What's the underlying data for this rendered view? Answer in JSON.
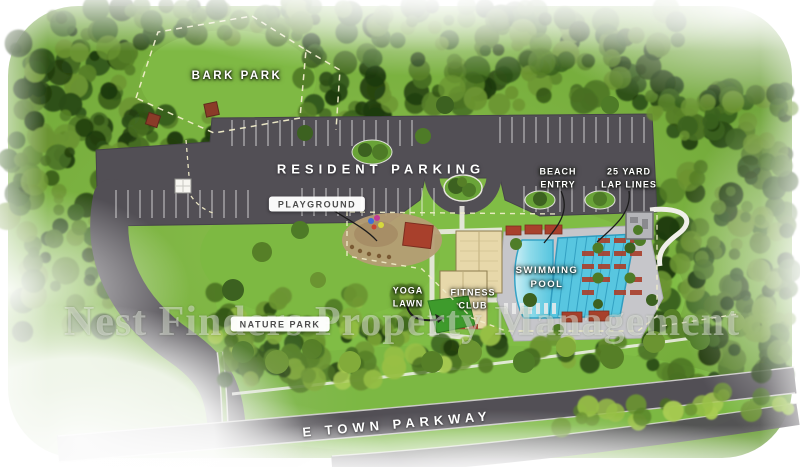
{
  "map": {
    "watermark": "Nest Finders Property Management",
    "areas": {
      "bark_park": {
        "label": "BARK PARK"
      },
      "resident_parking": {
        "label": "RESIDENT PARKING"
      },
      "playground": {
        "label": "PLAYGROUND"
      },
      "beach_entry": {
        "line1": "BEACH",
        "line2": "ENTRY"
      },
      "lap_lanes": {
        "line1": "25 YARD",
        "line2": "LAP LINES"
      },
      "swimming_pool": {
        "line1": "SWIMMING",
        "line2": "POOL"
      },
      "yoga_lawn": {
        "line1": "YOGA",
        "line2": "LAWN"
      },
      "fitness_club": {
        "line1": "FITNESS",
        "line2": "CLUB"
      },
      "nature_park": {
        "label": "NATURE PARK"
      },
      "e_town_parkway": {
        "label": "E TOWN PARKWAY"
      }
    },
    "colors": {
      "lawn": "#7cb443",
      "forest_dark": "#2e4c17",
      "asphalt": "#524f55",
      "pool_water": "#58c6e0",
      "pool_deck": "#c6c6ca",
      "building_tan": "#e7d8aa",
      "accent_red": "#a8402c",
      "playground_ground": "#b59d75",
      "dashed_outline": "#f2eecb"
    }
  }
}
